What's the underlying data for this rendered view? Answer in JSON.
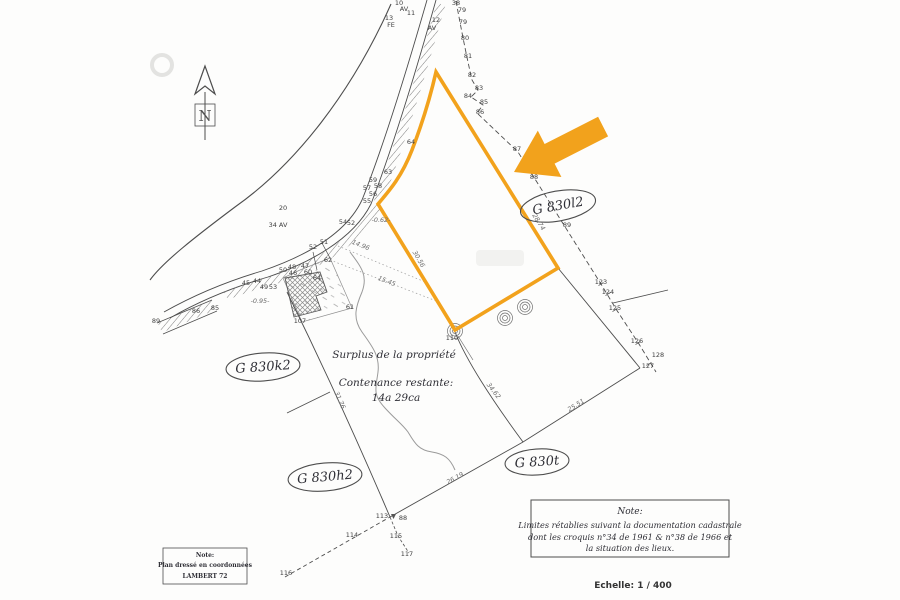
{
  "highlight_color": "#F2A21C",
  "ink_color": "#4d4d4d",
  "compass": {
    "letter": "N"
  },
  "parcel_labels": [
    {
      "text": "G 830l2"
    },
    {
      "text": "G 830k2"
    },
    {
      "text": "G 830h2"
    },
    {
      "text": "G 830t"
    }
  ],
  "annotations": {
    "surplus": "Surplus de la propriété",
    "contenance_label": "Contenance restante:",
    "contenance_value": "14a 29ca"
  },
  "notes": {
    "right": {
      "title": "Note:",
      "lines": [
        "Limites rétablies suivant la documentation cadastrale",
        "dont les croquis n°34 de 1961 & n°38 de 1966 et",
        "la situation des lieux."
      ]
    },
    "left": {
      "title": "Note:",
      "lines": [
        "Plan dressé en coordonnées",
        "LAMBERT 72"
      ]
    }
  },
  "scale_text": "Echelle: 1 / 400",
  "map_points": [
    {
      "t": "10",
      "x": 399,
      "y": 5
    },
    {
      "t": "11",
      "x": 411,
      "y": 15
    },
    {
      "t": "13",
      "x": 389,
      "y": 20
    },
    {
      "t": "FE",
      "x": 391,
      "y": 27
    },
    {
      "t": "AV",
      "x": 404,
      "y": 11
    },
    {
      "t": "12",
      "x": 436,
      "y": 22
    },
    {
      "t": "AV",
      "x": 432,
      "y": 30
    },
    {
      "t": "38",
      "x": 456,
      "y": 5
    },
    {
      "t": "79",
      "x": 462,
      "y": 12
    },
    {
      "t": "79",
      "x": 463,
      "y": 24
    },
    {
      "t": "80",
      "x": 465,
      "y": 40
    },
    {
      "t": "81",
      "x": 468,
      "y": 58
    },
    {
      "t": "82",
      "x": 472,
      "y": 77
    },
    {
      "t": "83",
      "x": 479,
      "y": 90
    },
    {
      "t": "84",
      "x": 468,
      "y": 98
    },
    {
      "t": "85",
      "x": 484,
      "y": 104
    },
    {
      "t": "86",
      "x": 480,
      "y": 114
    },
    {
      "t": "87",
      "x": 517,
      "y": 151
    },
    {
      "t": "88",
      "x": 534,
      "y": 179
    },
    {
      "t": "89",
      "x": 567,
      "y": 227
    },
    {
      "t": "123",
      "x": 601,
      "y": 284
    },
    {
      "t": "124",
      "x": 608,
      "y": 294
    },
    {
      "t": "125",
      "x": 615,
      "y": 310
    },
    {
      "t": "126",
      "x": 637,
      "y": 343
    },
    {
      "t": "128",
      "x": 658,
      "y": 357
    },
    {
      "t": "127",
      "x": 648,
      "y": 368
    },
    {
      "t": "113",
      "x": 382,
      "y": 518
    },
    {
      "t": "88",
      "x": 403,
      "y": 520
    },
    {
      "t": "114",
      "x": 352,
      "y": 537
    },
    {
      "t": "115",
      "x": 396,
      "y": 538
    },
    {
      "t": "117",
      "x": 407,
      "y": 556
    },
    {
      "t": "116",
      "x": 286,
      "y": 575
    },
    {
      "t": "89",
      "x": 156,
      "y": 323
    },
    {
      "t": "86",
      "x": 196,
      "y": 313
    },
    {
      "t": "85",
      "x": 215,
      "y": 310
    },
    {
      "t": "44",
      "x": 257,
      "y": 283
    },
    {
      "t": "45",
      "x": 246,
      "y": 285
    },
    {
      "t": "49",
      "x": 264,
      "y": 289
    },
    {
      "t": "53",
      "x": 273,
      "y": 289
    },
    {
      "t": "50",
      "x": 283,
      "y": 272
    },
    {
      "t": "48",
      "x": 292,
      "y": 269
    },
    {
      "t": "46",
      "x": 293,
      "y": 275
    },
    {
      "t": "47",
      "x": 305,
      "y": 268
    },
    {
      "t": "60",
      "x": 308,
      "y": 274
    },
    {
      "t": "64",
      "x": 317,
      "y": 280
    },
    {
      "t": "62",
      "x": 328,
      "y": 262
    },
    {
      "t": "52",
      "x": 313,
      "y": 249
    },
    {
      "t": "51",
      "x": 324,
      "y": 244
    },
    {
      "t": "54",
      "x": 343,
      "y": 224
    },
    {
      "t": "52",
      "x": 351,
      "y": 225
    },
    {
      "t": "55",
      "x": 367,
      "y": 203
    },
    {
      "t": "56",
      "x": 373,
      "y": 196
    },
    {
      "t": "57",
      "x": 367,
      "y": 190
    },
    {
      "t": "58",
      "x": 378,
      "y": 188
    },
    {
      "t": "59",
      "x": 373,
      "y": 182
    },
    {
      "t": "63",
      "x": 388,
      "y": 174
    },
    {
      "t": "64",
      "x": 411,
      "y": 144
    },
    {
      "t": "61",
      "x": 350,
      "y": 309
    },
    {
      "t": "107",
      "x": 300,
      "y": 323
    },
    {
      "t": "110",
      "x": 452,
      "y": 340
    },
    {
      "t": "20",
      "x": 283,
      "y": 210
    },
    {
      "t": "34 AV",
      "x": 278,
      "y": 227
    }
  ],
  "dimension_labels": [
    {
      "t": "14.96",
      "x": 360,
      "y": 247,
      "r": 22
    },
    {
      "t": "15.45",
      "x": 386,
      "y": 283,
      "r": 21
    },
    {
      "t": "-0.62-",
      "x": 381,
      "y": 222,
      "r": 0
    },
    {
      "t": "-0.95-",
      "x": 260,
      "y": 303,
      "r": 0
    },
    {
      "t": "28.74",
      "x": 537,
      "y": 223,
      "r": 58
    },
    {
      "t": "30.56",
      "x": 417,
      "y": 260,
      "r": 60
    },
    {
      "t": "31.76",
      "x": 338,
      "y": 401,
      "r": 66
    },
    {
      "t": "34.62",
      "x": 492,
      "y": 392,
      "r": 52
    },
    {
      "t": "25.51",
      "x": 577,
      "y": 407,
      "r": -32
    },
    {
      "t": "26.19",
      "x": 456,
      "y": 480,
      "r": -29
    }
  ]
}
